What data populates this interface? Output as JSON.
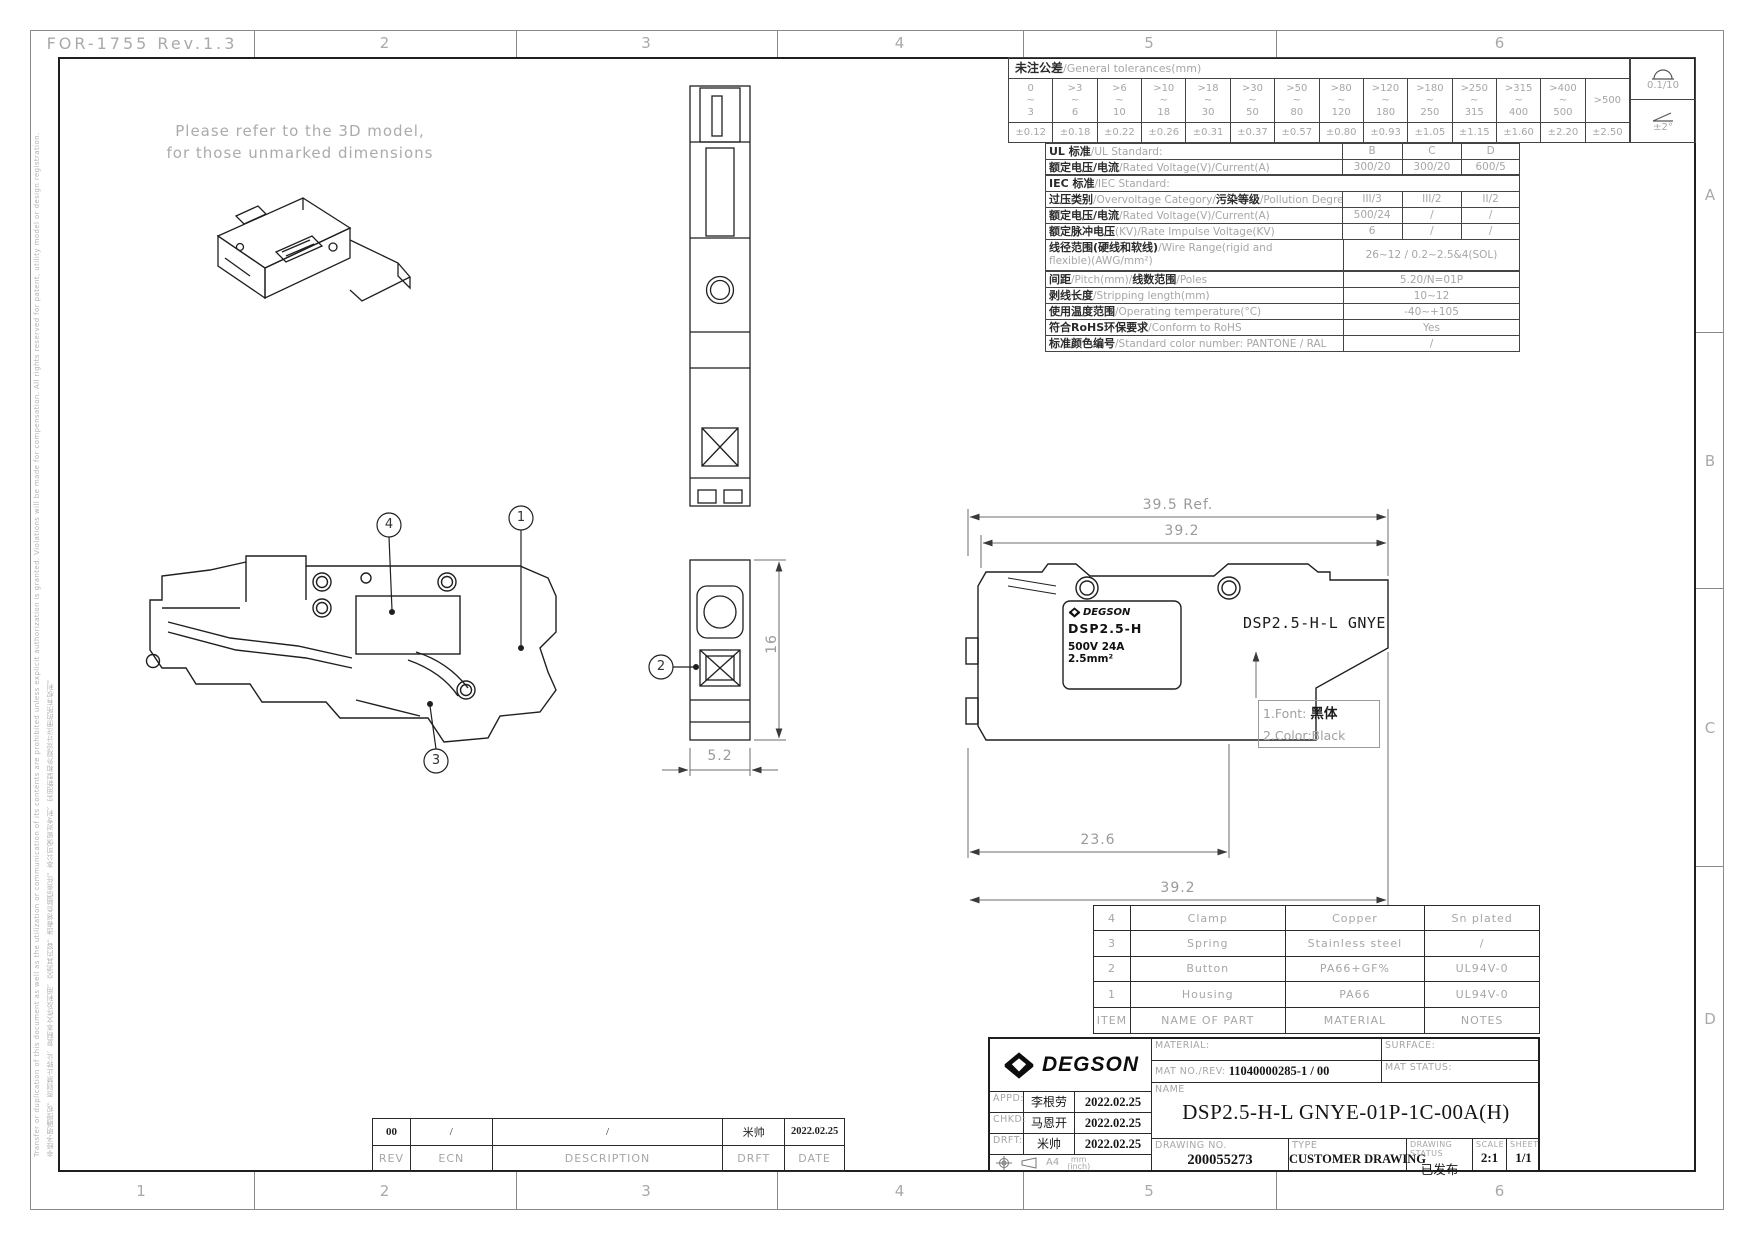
{
  "colors": {
    "drawing_line": "#1a1a1a",
    "muted_text": "#9c9c9c",
    "brand_black": "#111111"
  },
  "sheet": {
    "form_no": "FOR-1755 Rev.1.3",
    "cols_top": [
      "2",
      "3",
      "4",
      "5",
      "6"
    ],
    "cols_bottom": [
      "1",
      "2",
      "3",
      "4",
      "5",
      "6"
    ],
    "rows_right": [
      "A",
      "B",
      "C",
      "D"
    ],
    "note_line1": "Please refer to the 3D model,",
    "note_line2": "for those unmarked dimensions",
    "side_text_en": "Transfer or duplication of this document as well as the utilization or communication of its contents are prohibited unless explicit authorization is granted. Violations will be made for compensation. All rights reserved for patent, utility model or design registration.",
    "side_text_cn": "非经予明确授权，否则禁止转让、复制本文件及利用、交流其内容，违者将负赔偿责任。本公司保留对专利、实用新型和外观设计注册的所有权利。"
  },
  "tolerance": {
    "title_cn": "未注公差",
    "title_en": "/General tolerances(mm)",
    "flatness": "0.1/10",
    "angle": "±2°",
    "cols": [
      {
        "top": "0",
        "mid": "~",
        "bot": "3",
        "val": "±0.12"
      },
      {
        "top": ">3",
        "mid": "~",
        "bot": "6",
        "val": "±0.18"
      },
      {
        "top": ">6",
        "mid": "~",
        "bot": "10",
        "val": "±0.22"
      },
      {
        "top": ">10",
        "mid": "~",
        "bot": "18",
        "val": "±0.26"
      },
      {
        "top": ">18",
        "mid": "~",
        "bot": "30",
        "val": "±0.31"
      },
      {
        "top": ">30",
        "mid": "~",
        "bot": "50",
        "val": "±0.37"
      },
      {
        "top": ">50",
        "mid": "~",
        "bot": "80",
        "val": "±0.57"
      },
      {
        "top": ">80",
        "mid": "~",
        "bot": "120",
        "val": "±0.80"
      },
      {
        "top": ">120",
        "mid": "~",
        "bot": "180",
        "val": "±0.93"
      },
      {
        "top": ">180",
        "mid": "~",
        "bot": "250",
        "val": "±1.05"
      },
      {
        "top": ">250",
        "mid": "~",
        "bot": "315",
        "val": "±1.15"
      },
      {
        "top": ">315",
        "mid": "~",
        "bot": "400",
        "val": "±1.60"
      },
      {
        "top": ">400",
        "mid": "~",
        "bot": "500",
        "val": "±2.20"
      },
      {
        "top": ">500",
        "mid": "",
        "bot": "",
        "val": "±2.50"
      }
    ]
  },
  "specs": {
    "rows": [
      {
        "c1": "UL 标准",
        "e1": "/UL Standard:",
        "v1": "B",
        "v2": "C",
        "v3": "D"
      },
      {
        "c1": "额定电压/电流",
        "e1": "/Rated Voltage(V)/Current(A)",
        "v1": "300/20",
        "v2": "300/20",
        "v3": "600/5"
      },
      {
        "c1": "IEC 标准",
        "e1": "/IEC Standard:"
      },
      {
        "c1": "过压类别",
        "e1": "/Overvoltage Category/",
        "c2": "污染等级",
        "e2": "/Pollution Degree",
        "v1": "III/3",
        "v2": "III/2",
        "v3": "II/2"
      },
      {
        "c1": "额定电压/电流",
        "e1": "/Rated Voltage(V)/Current(A)",
        "v1": "500/24",
        "v2": "/",
        "v3": "/"
      },
      {
        "c1": "额定脉冲电压",
        "e1": "(KV)/Rate Impulse Voltage(KV)",
        "v1": "6",
        "v2": "/",
        "v3": "/"
      },
      {
        "c1": "线径范围(硬线和软线)",
        "e1": "/Wire Range(rigid and",
        "e1b": "flexible)(AWG/mm²)",
        "val": "26~12 / 0.2~2.5&4(SOL)"
      },
      {
        "c1": "间距",
        "e1": "/Pitch(mm)/",
        "c2": "线数范围",
        "e2": "/Poles",
        "val": "5.20/N=01P"
      },
      {
        "c1": "剥线长度",
        "e1": "/Stripping length(mm)",
        "val": "10~12"
      },
      {
        "c1": "使用温度范围",
        "e1": "/Operating temperature(°C)",
        "val": "-40~+105"
      },
      {
        "c1": "符合RoHS环保要求",
        "e1": "/Conform to RoHS",
        "val": "Yes"
      },
      {
        "c1": "标准颜色编号",
        "e1": "/Standard color number: PANTONE / RAL",
        "val": "/"
      }
    ]
  },
  "dims": {
    "overall_ref": "39.5 Ref.",
    "overall_top": "39.2",
    "front_width": "23.6",
    "overall_bottom": "39.2",
    "section_height": "16",
    "pitch": "5.2"
  },
  "balloons": {
    "b1": "1",
    "b2": "2",
    "b3": "3",
    "b4": "4"
  },
  "product_label": {
    "brand": "DEGSON",
    "model": "DSP2.5-H",
    "rating_line1": "500V 24A",
    "rating_line2": "2.5mm²"
  },
  "marking": {
    "text": "DSP2.5-H-L GNYE",
    "note1_label": "1.Font: ",
    "note1_value": "黑体",
    "note2": "2.Color:Black"
  },
  "parts": {
    "headers": {
      "item": "ITEM",
      "name": "NAME OF PART",
      "material": "MATERIAL",
      "notes": "NOTES"
    },
    "rows": [
      {
        "item": "4",
        "name": "Clamp",
        "material": "Copper",
        "notes": "Sn plated"
      },
      {
        "item": "3",
        "name": "Spring",
        "material": "Stainless steel",
        "notes": "/"
      },
      {
        "item": "2",
        "name": "Button",
        "material": "PA66+GF%",
        "notes": "UL94V-0"
      },
      {
        "item": "1",
        "name": "Housing",
        "material": "PA66",
        "notes": "UL94V-0"
      }
    ]
  },
  "titleblock": {
    "brand": "DEGSON",
    "material_label": "MATERIAL:",
    "mat_no_label": "MAT NO./REV:",
    "mat_no_value": "11040000285-1  / 00",
    "surface_label": "SURFACE:",
    "mat_status_label": "MAT STATUS:",
    "appd_label": "APPD:",
    "appd_name": "李根劳",
    "appd_date": "2022.02.25",
    "chkd_label": "CHKD:",
    "chkd_name": "马恩开",
    "chkd_date": "2022.02.25",
    "drft_label": "DRFT:",
    "drft_name": "米帅",
    "drft_date": "2022.02.25",
    "paper": "A4",
    "units_top": "mm",
    "units_bottom": "(inch)",
    "name_label": "NAME",
    "name_value": "DSP2.5-H-L GNYE-01P-1C-00A(H)",
    "drawing_no_label": "DRAWING NO.",
    "drawing_no_value": "200055273",
    "type_label": "TYPE",
    "type_value": "CUSTOMER DRAWING",
    "status_label": "DRAWING STATUS",
    "status_value": "已发布",
    "scale_label": "SCALE",
    "scale_value": "2:1",
    "sheet_label": "SHEET",
    "sheet_value": "1/1"
  },
  "revision": {
    "rev": "00",
    "ecn": "/",
    "description": "/",
    "drft": "米帅",
    "date": "2022.02.25",
    "headers": {
      "rev": "REV",
      "ecn": "ECN",
      "description": "DESCRIPTION",
      "drft": "DRFT",
      "date": "DATE"
    }
  }
}
